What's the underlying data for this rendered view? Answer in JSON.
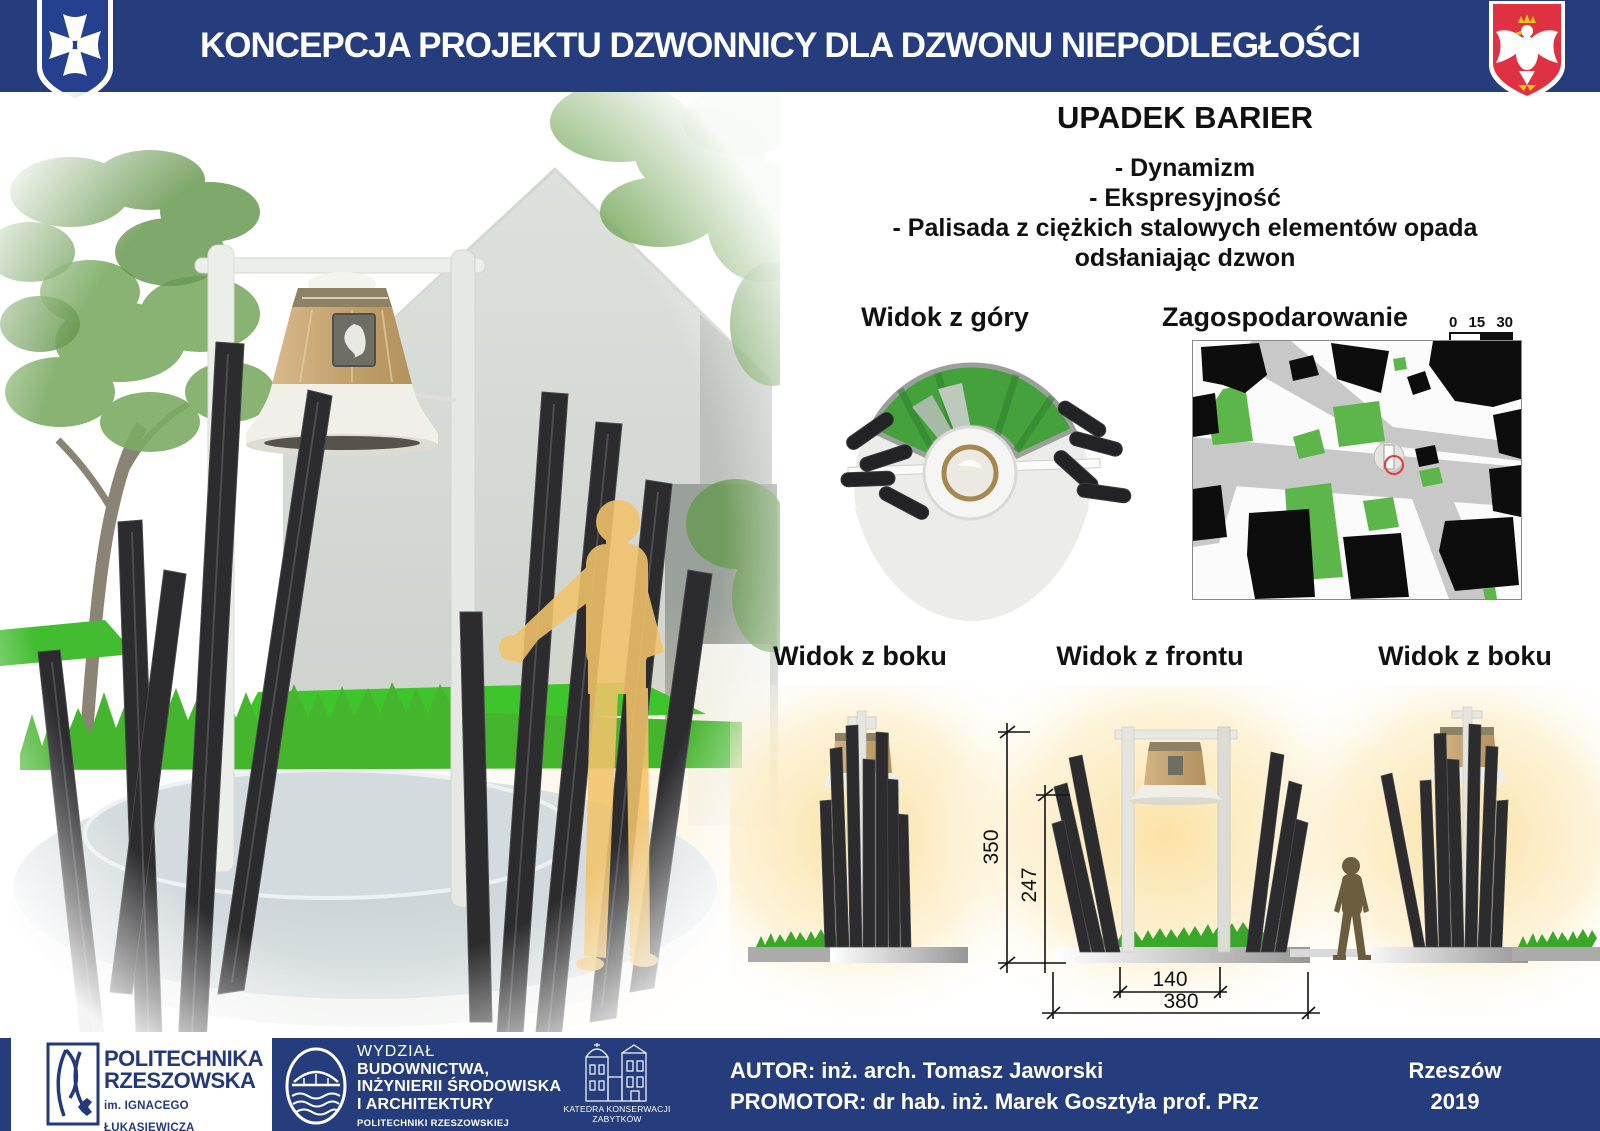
{
  "header": {
    "title": "KONCEPCJA PROJEKTU DZWONNICY DLA DZWONU NIEPODLEGŁOŚCI",
    "crest_name": "herb Rzeszowa",
    "eagle_name": "godło Polski"
  },
  "concept": {
    "heading": "UPADEK BARIER",
    "bullets": [
      "- Dynamizm",
      "- Ekspresyjność",
      "- Palisada z ciężkich stalowych elementów opada odsłaniając dzwon"
    ]
  },
  "views": {
    "top_view_label": "Widok z góry",
    "site_plan_label": "Zagospodarowanie",
    "scale": {
      "labels": [
        "0",
        "15",
        "30"
      ]
    },
    "side_left_label": "Widok z boku",
    "front_label": "Widok z frontu",
    "side_right_label": "Widok z boku"
  },
  "dimensions": {
    "total_height": "350",
    "posts_height": "247",
    "inner_width": "140",
    "total_width": "380"
  },
  "footer": {
    "university": {
      "line1": "POLITECHNIKA",
      "line2": "RZESZOWSKA",
      "line3": "im. IGNACEGO ŁUKASIEWICZA"
    },
    "faculty": {
      "lines": [
        "WYDZIAŁ",
        "BUDOWNICTWA,",
        "INŻYNIERII ŚRODOWISKA",
        "I ARCHITEKTURY",
        "POLITECHNIKI RZESZOWSKIEJ"
      ]
    },
    "department": {
      "lines": [
        "KATEDRA KONSERWACJI",
        "ZABYTKÓW"
      ]
    },
    "author_line": "AUTOR: inż. arch. Tomasz Jaworski",
    "promotor_line": "PROMOTOR:  dr hab. inż. Marek Gosztyła prof. PRz",
    "city": "Rzeszów",
    "year": "2019"
  },
  "colors": {
    "banner_navy": "#253c7d",
    "eagle_red": "#df3142",
    "grass_green": "#44b52e",
    "silhouette_yellow": "#f2c36a",
    "steel_post": "#2c2c2e"
  }
}
